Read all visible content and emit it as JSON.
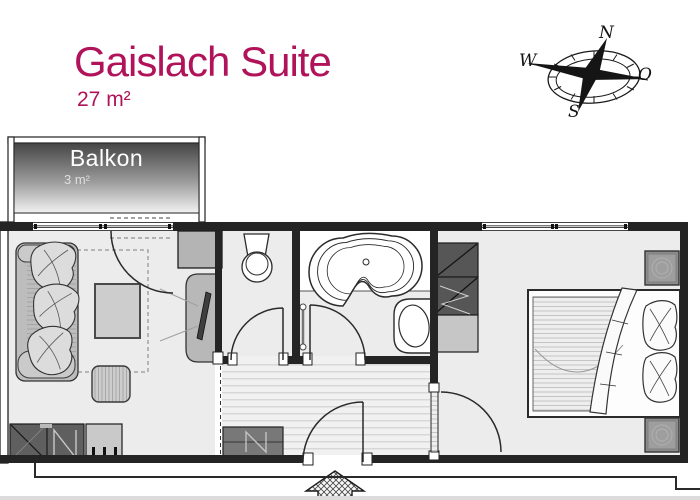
{
  "header": {
    "title": "Gaislach Suite",
    "area": "27 m²"
  },
  "balcony": {
    "label": "Balkon",
    "area": "3 m²"
  },
  "compass": {
    "north": "N",
    "east": "O",
    "south": "S",
    "west": "W"
  },
  "colors": {
    "accent_magenta": "#b01359",
    "wall_dark": "#242424",
    "floor_gray": "#ececec",
    "furniture_gray": "#c6c6c6",
    "cabinet_dark": "#5f5f5f"
  }
}
